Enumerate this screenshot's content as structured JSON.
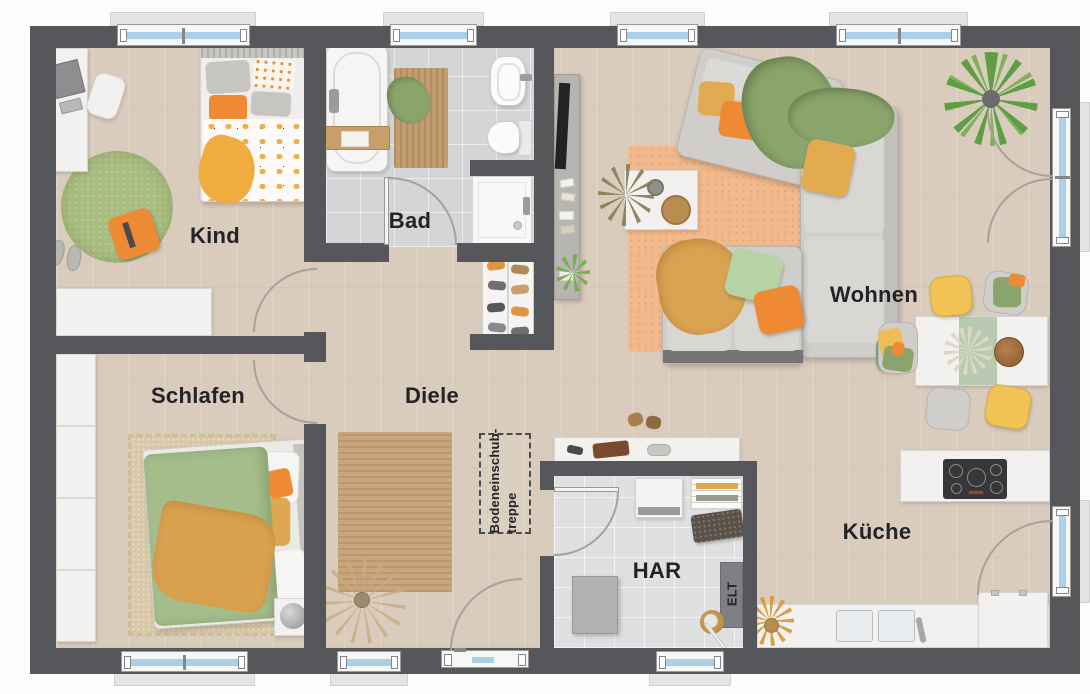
{
  "plan_title": "Erdgeschoss Grundriss",
  "rooms": {
    "kind": {
      "label": "Kind"
    },
    "bad": {
      "label": "Bad"
    },
    "wohnen": {
      "label": "Wohnen"
    },
    "schlafen": {
      "label": "Schlafen"
    },
    "diele": {
      "label": "Diele"
    },
    "har": {
      "label": "HAR"
    },
    "kueche": {
      "label": "Küche"
    }
  },
  "annotations": {
    "attic_stairs": {
      "line1": "Bodeneinschub-",
      "line2": "treppe"
    },
    "elt": {
      "label": "ELT"
    }
  },
  "colors": {
    "wall": "#56575b",
    "floor": "#d9ccbd",
    "bathTile": "#d3d5d7",
    "harTile": "#dfe0e1",
    "glass": "#a9d0e8",
    "accentOrange": "#ee8a33",
    "accentYellow": "#e8b04e",
    "accentOlive": "#8aa46c",
    "accentLightGreen": "#b7d3a4",
    "rugPeach": "#f2ba8c",
    "rugGreen": "#a9bd80",
    "rugTan": "#d9c9a9",
    "rugJute": "#c8a67b",
    "sofaGray": "#cfcecb",
    "furnitureWhite": "#f2f1ef",
    "cooktopDark": "#37373a",
    "labelColor": "#232325"
  }
}
